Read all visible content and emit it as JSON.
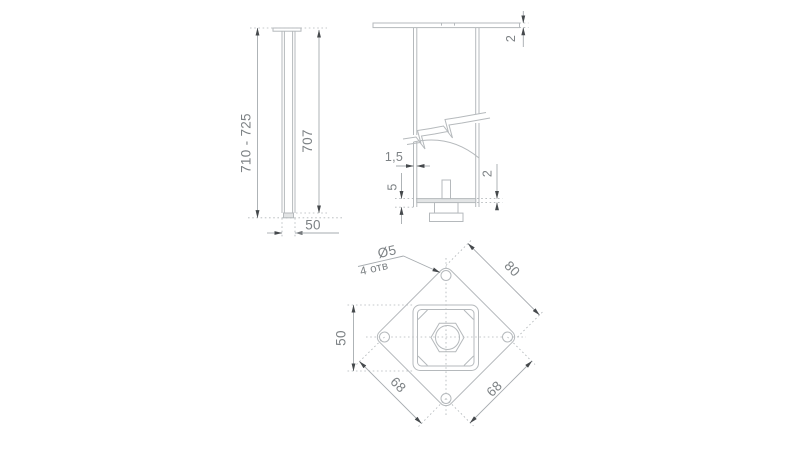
{
  "drawing": {
    "type": "technical-drawing",
    "subject": "adjustable furniture leg with square mounting plate",
    "colors": {
      "background": "#ffffff",
      "geometry_line": "#b5b9bc",
      "dimension_line": "#a6abaf",
      "arrowhead": "#45494c",
      "dimension_text": "#7d8285",
      "fill_light_gray": "#e2e4e5"
    },
    "views": {
      "side_view": {
        "height_range": "710 - 725",
        "stem_height": "707",
        "tube_width": "50"
      },
      "section_view": {
        "top_plate_thickness": "2",
        "wall_thickness": "1,5",
        "glide_offset": "5",
        "base_plate_thickness": "2"
      },
      "plan_view": {
        "plate_size": "80",
        "tube_size": "50",
        "hole_pitch_left": "68",
        "hole_pitch_right": "68",
        "hole_diameter": "Ø5",
        "hole_count_note": "4 отв"
      }
    }
  }
}
